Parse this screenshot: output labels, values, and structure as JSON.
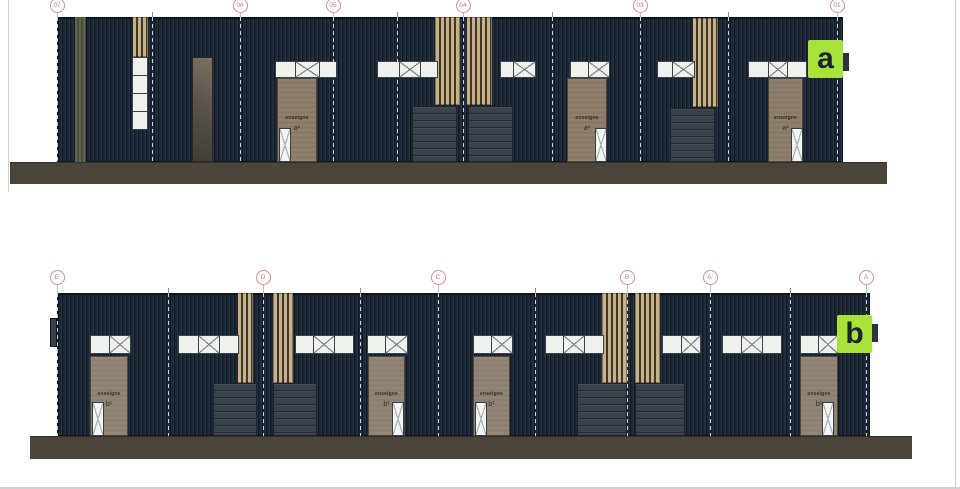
{
  "page": {
    "width": 960,
    "height": 489,
    "background": "#ffffff",
    "border_lines": [
      {
        "x": 8,
        "y": 0,
        "w": 1,
        "h": 192
      },
      {
        "x": 955,
        "y": 0,
        "w": 1,
        "h": 489
      },
      {
        "x": 0,
        "y": 487,
        "w": 960,
        "h": 2
      }
    ]
  },
  "labels": {
    "sign_text": "enseigne"
  },
  "colors": {
    "facade": "#1d2836",
    "facade_line": "#0e1520",
    "wood": "#c7b287",
    "wood_gap": "#3e382c",
    "panel_brown_a": "#897a67",
    "panel_brown_b": "#8c8072",
    "panel_border": "#4e4639",
    "gray_stripe_light": "#60644f",
    "gray_stripe_dark": "#494d3b",
    "garage": "#39414a",
    "garage_line": "#232a31",
    "ground": "#4a443b",
    "ground_edge": "#33302a",
    "pane_white": "#eef1ec",
    "frame": "#3c4247",
    "diag_line": "#7d848b",
    "door_white": "#f2f5f1",
    "door_line": "#aab0b5",
    "badge_green": "#a9e338",
    "badge_letter": "#1a2430",
    "badge_tab": "#2c3442",
    "side_tab": "#39404a",
    "grid_circle_border": "#d49090",
    "grid_label": "#ab8484",
    "leader": "#c0c0c0",
    "tick": "#8b8b8b",
    "dash": "rgba(235,240,245,0.85)",
    "sign_color": "#332e27",
    "dark_panel_grad_a": "#7b7063",
    "dark_panel_grad_b": "#403c37"
  },
  "elevations": [
    {
      "id": "a",
      "badge": {
        "letter": "a",
        "x": 808,
        "y": 40,
        "w": 35,
        "h": 38,
        "tab": {
          "x": 843,
          "y": 53,
          "w": 6,
          "h": 18
        }
      },
      "building": {
        "x": 57,
        "y": 17,
        "w": 786,
        "h": 145
      },
      "ground": {
        "x": 10,
        "y": 162,
        "w": 877,
        "h": 22
      },
      "grid": {
        "circle_cy": 5,
        "markers": [
          {
            "label": "07",
            "x": 57
          },
          {
            "label": "06",
            "x": 240
          },
          {
            "label": "05",
            "x": 333
          },
          {
            "label": "04",
            "x": 463
          },
          {
            "label": "03",
            "x": 640
          },
          {
            "label": "01",
            "x": 837
          }
        ],
        "ticks": [
          152,
          397,
          552,
          728
        ]
      },
      "unit_glyph": "a¹",
      "gray_stripes": [
        {
          "x": 75,
          "y": 17,
          "w": 11,
          "h": 145
        }
      ],
      "side_tabs": [],
      "wood_panels": [
        {
          "x": 132,
          "y": 17,
          "w": 16,
          "h": 40
        },
        {
          "x": 435,
          "y": 17,
          "w": 25,
          "h": 88
        },
        {
          "x": 466,
          "y": 17,
          "w": 26,
          "h": 88
        },
        {
          "x": 692,
          "y": 18,
          "w": 26,
          "h": 89
        }
      ],
      "stacked_windows": [
        {
          "x": 132,
          "y": 57,
          "w": 16,
          "h": 73,
          "panes": 4
        }
      ],
      "dark_panels": [
        {
          "x": 192,
          "y": 57,
          "w": 21,
          "h": 105
        }
      ],
      "window_bands": [
        {
          "x": 275,
          "y": 61,
          "h": 17,
          "panes": [
            "w19",
            "d23",
            "w16"
          ]
        },
        {
          "x": 377,
          "y": 61,
          "h": 17,
          "panes": [
            "w21",
            "d20",
            "w16"
          ]
        },
        {
          "x": 500,
          "y": 61,
          "h": 17,
          "panes": [
            "w12",
            "d21"
          ]
        },
        {
          "x": 570,
          "y": 61,
          "h": 17,
          "panes": [
            "w17",
            "d20"
          ]
        },
        {
          "x": 657,
          "y": 61,
          "h": 17,
          "panes": [
            "w14",
            "d21"
          ]
        },
        {
          "x": 748,
          "y": 61,
          "h": 17,
          "panes": [
            "w19",
            "d18",
            "w18"
          ]
        }
      ],
      "garage_doors": [
        {
          "x": 412,
          "y": 106,
          "w": 45,
          "h": 56
        },
        {
          "x": 468,
          "y": 106,
          "w": 45,
          "h": 56
        },
        {
          "x": 670,
          "y": 108,
          "w": 45,
          "h": 54
        }
      ],
      "entrances": [
        {
          "panel": {
            "x": 277,
            "y": 78,
            "w": 40,
            "h": 84
          },
          "door": {
            "x": 279,
            "y": 128,
            "w": 12,
            "h": 34
          }
        },
        {
          "panel": {
            "x": 567,
            "y": 78,
            "w": 40,
            "h": 84
          },
          "door": {
            "x": 595,
            "y": 128,
            "w": 12,
            "h": 34
          }
        },
        {
          "panel": {
            "x": 768,
            "y": 78,
            "w": 35,
            "h": 84
          },
          "door": {
            "x": 791,
            "y": 128,
            "w": 12,
            "h": 34
          }
        }
      ]
    },
    {
      "id": "b",
      "badge": {
        "letter": "b",
        "x": 837,
        "y": 315,
        "w": 35,
        "h": 38,
        "tab": {
          "x": 872,
          "y": 324,
          "w": 6,
          "h": 18
        }
      },
      "building": {
        "x": 57,
        "y": 293,
        "w": 813,
        "h": 143
      },
      "ground": {
        "x": 30,
        "y": 436,
        "w": 882,
        "h": 23
      },
      "grid": {
        "circle_cy": 277,
        "markers": [
          {
            "label": "E",
            "x": 57
          },
          {
            "label": "D",
            "x": 263
          },
          {
            "label": "C",
            "x": 438
          },
          {
            "label": "B",
            "x": 627
          },
          {
            "label": "A'",
            "x": 710
          },
          {
            "label": "A",
            "x": 866
          }
        ],
        "ticks": [
          168,
          360,
          535,
          790
        ]
      },
      "unit_glyph": "b¹",
      "gray_stripes": [],
      "side_tabs": [
        {
          "x": 50,
          "y": 318,
          "w": 7,
          "h": 29
        }
      ],
      "wood_panels": [
        {
          "x": 237,
          "y": 293,
          "w": 16,
          "h": 90
        },
        {
          "x": 273,
          "y": 293,
          "w": 20,
          "h": 90
        },
        {
          "x": 602,
          "y": 293,
          "w": 25,
          "h": 90
        },
        {
          "x": 635,
          "y": 293,
          "w": 25,
          "h": 90
        }
      ],
      "stacked_windows": [],
      "dark_panels": [],
      "window_bands": [
        {
          "x": 90,
          "y": 335,
          "h": 19,
          "panes": [
            "w18",
            "d20"
          ]
        },
        {
          "x": 178,
          "y": 335,
          "h": 19,
          "panes": [
            "w19",
            "d20",
            "w18"
          ]
        },
        {
          "x": 295,
          "y": 335,
          "h": 19,
          "panes": [
            "w17",
            "d20",
            "w18"
          ]
        },
        {
          "x": 367,
          "y": 335,
          "h": 19,
          "panes": [
            "w17",
            "d21"
          ]
        },
        {
          "x": 473,
          "y": 335,
          "h": 19,
          "panes": [
            "w17",
            "d20"
          ]
        },
        {
          "x": 545,
          "y": 335,
          "h": 19,
          "panes": [
            "w17",
            "d20",
            "w18"
          ]
        },
        {
          "x": 662,
          "y": 335,
          "h": 19,
          "panes": [
            "w18",
            "d18"
          ]
        },
        {
          "x": 722,
          "y": 335,
          "h": 19,
          "panes": [
            "w18",
            "d20",
            "w18"
          ]
        },
        {
          "x": 800,
          "y": 335,
          "h": 19,
          "panes": [
            "w17",
            "d18"
          ]
        }
      ],
      "garage_doors": [
        {
          "x": 213,
          "y": 383,
          "w": 44,
          "h": 53
        },
        {
          "x": 273,
          "y": 383,
          "w": 44,
          "h": 53
        },
        {
          "x": 577,
          "y": 383,
          "w": 50,
          "h": 53
        },
        {
          "x": 635,
          "y": 383,
          "w": 50,
          "h": 53
        }
      ],
      "entrances": [
        {
          "panel": {
            "x": 90,
            "y": 356,
            "w": 38,
            "h": 80
          },
          "door": {
            "x": 92,
            "y": 402,
            "w": 12,
            "h": 34
          }
        },
        {
          "panel": {
            "x": 368,
            "y": 356,
            "w": 37,
            "h": 80
          },
          "door": {
            "x": 392,
            "y": 402,
            "w": 12,
            "h": 34
          }
        },
        {
          "panel": {
            "x": 473,
            "y": 356,
            "w": 37,
            "h": 80
          },
          "door": {
            "x": 475,
            "y": 402,
            "w": 12,
            "h": 34
          }
        },
        {
          "panel": {
            "x": 800,
            "y": 356,
            "w": 38,
            "h": 80
          },
          "door": {
            "x": 822,
            "y": 402,
            "w": 12,
            "h": 34
          }
        }
      ]
    }
  ]
}
